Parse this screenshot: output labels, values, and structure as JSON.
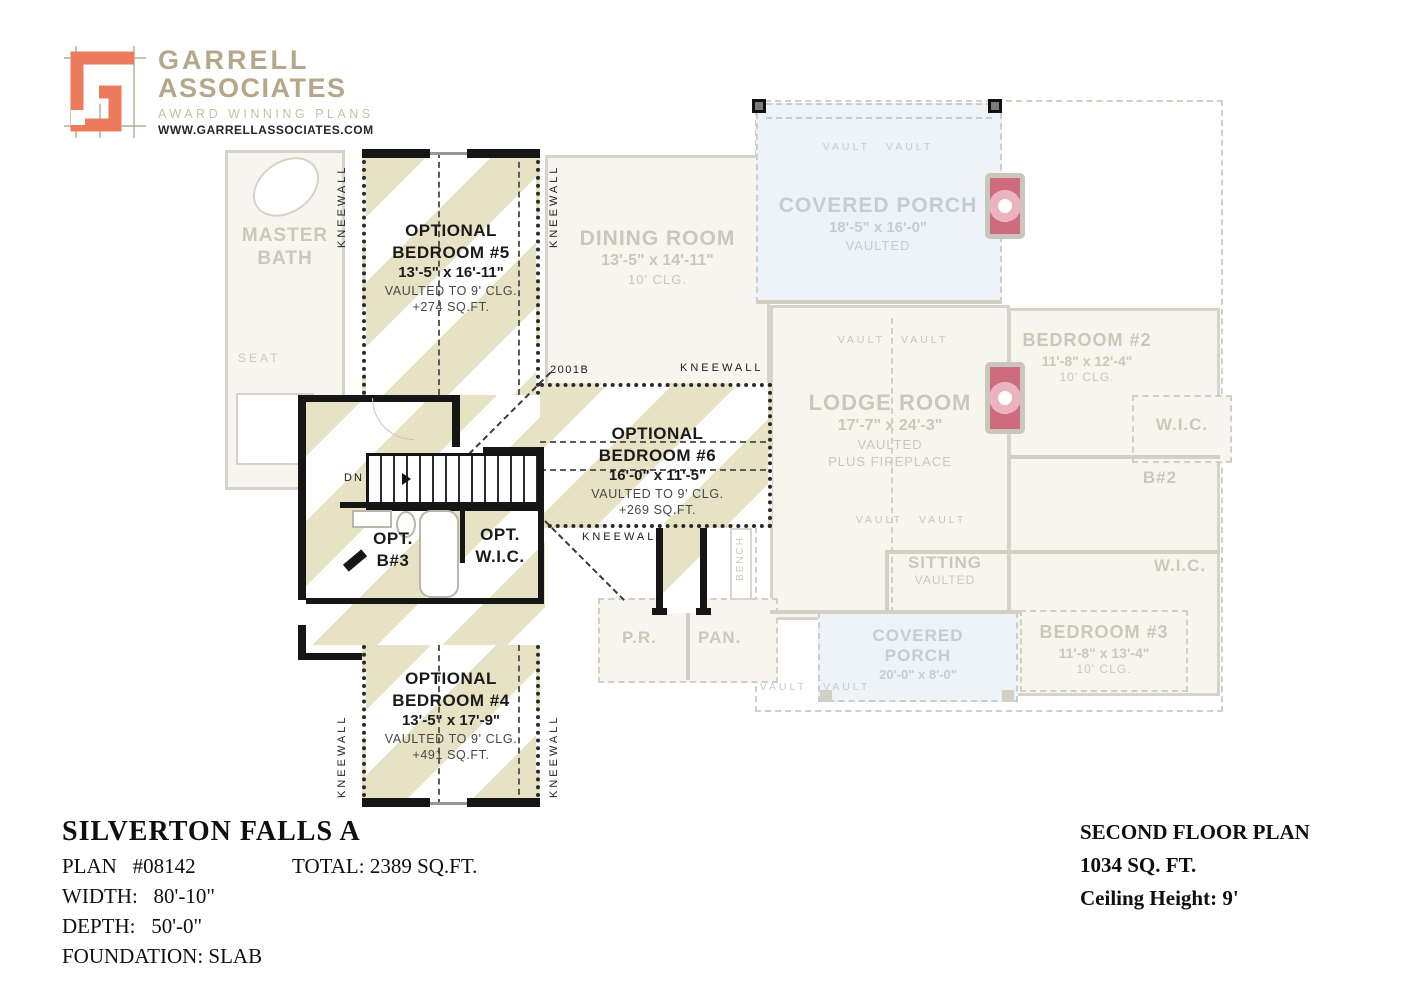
{
  "logo": {
    "line1": "GARRELL",
    "line2": "ASSOCIATES",
    "tagline": "AWARD WINNING PLANS",
    "website": "WWW.GARRELLASSOCIATES.COM"
  },
  "labels": {
    "kneewall": "KNEEWALL",
    "vault": "VAULT",
    "dn": "DN",
    "stair_ref": "2001B",
    "bench": "BENCH"
  },
  "rooms_active": {
    "bed5": {
      "l1": "OPTIONAL",
      "l2": "BEDROOM #5",
      "dims": "13'-5\" x 16'-11\"",
      "note": "VAULTED TO 9' CLG.",
      "area": "+274 SQ.FT."
    },
    "bed6": {
      "l1": "OPTIONAL",
      "l2": "BEDROOM #6",
      "dims": "16'-0\" x 11'-5\"",
      "note": "VAULTED TO 9' CLG.",
      "area": "+269 SQ.FT."
    },
    "bed4": {
      "l1": "OPTIONAL",
      "l2": "BEDROOM #4",
      "dims": "13'-5\" x 17'-9\"",
      "note": "VAULTED TO 9' CLG.",
      "area": "+491 SQ.FT."
    },
    "opt_b3": {
      "l1": "OPT.",
      "l2": "B#3"
    },
    "opt_wic": {
      "l1": "OPT.",
      "l2": "W.I.C."
    }
  },
  "rooms_faded": {
    "master_bath": {
      "l1": "MASTER",
      "l2": "BATH",
      "seat": "SEAT"
    },
    "dining": {
      "name": "DINING ROOM",
      "dims": "13'-5\" x 14'-11\"",
      "clg": "10' CLG."
    },
    "porch_top": {
      "name": "COVERED PORCH",
      "dims": "18'-5\" x 16'-0\"",
      "note": "VAULTED"
    },
    "lodge": {
      "name": "LODGE ROOM",
      "dims": "17'-7\" x 24'-3\"",
      "n1": "VAULTED",
      "n2": "PLUS FIREPLACE"
    },
    "bedroom2": {
      "name": "BEDROOM #2",
      "dims": "11'-8\" x 12'-4\"",
      "clg": "10' CLG."
    },
    "wic_upper": "W.I.C.",
    "b2": "B#2",
    "sitting": {
      "name": "SITTING",
      "note": "VAULTED"
    },
    "wic_lower": "W.I.C.",
    "bedroom3": {
      "name": "BEDROOM #3",
      "dims": "11'-8\" x 13'-4\"",
      "clg": "10' CLG."
    },
    "porch_bottom": {
      "l1": "COVERED",
      "l2": "PORCH",
      "dims": "20'-0\" x 8'-0\""
    },
    "pr": "P.R.",
    "pan": "PAN."
  },
  "title_block": {
    "name": "SILVERTON FALLS A",
    "plan": "PLAN   #08142",
    "total": "TOTAL: 2389 SQ.FT.",
    "width": "WIDTH:   80'-10\"",
    "depth": "DEPTH:   50'-0\"",
    "foundation": "FOUNDATION: SLAB"
  },
  "floor_info": {
    "l1": "SECOND FLOOR PLAN",
    "l2": "1034 SQ. FT.",
    "l3": "Ceiling Height: 9'"
  },
  "colors": {
    "logo_coral": "#ec7a5d",
    "logo_tan": "#b3a98a",
    "stripe_tan": "#e8e2c5",
    "porch_blue": "#eef3f8",
    "fireplace_pink": "#cf6b7e",
    "active_wall": "#161616",
    "faded_gray": "#d2cfc4"
  }
}
